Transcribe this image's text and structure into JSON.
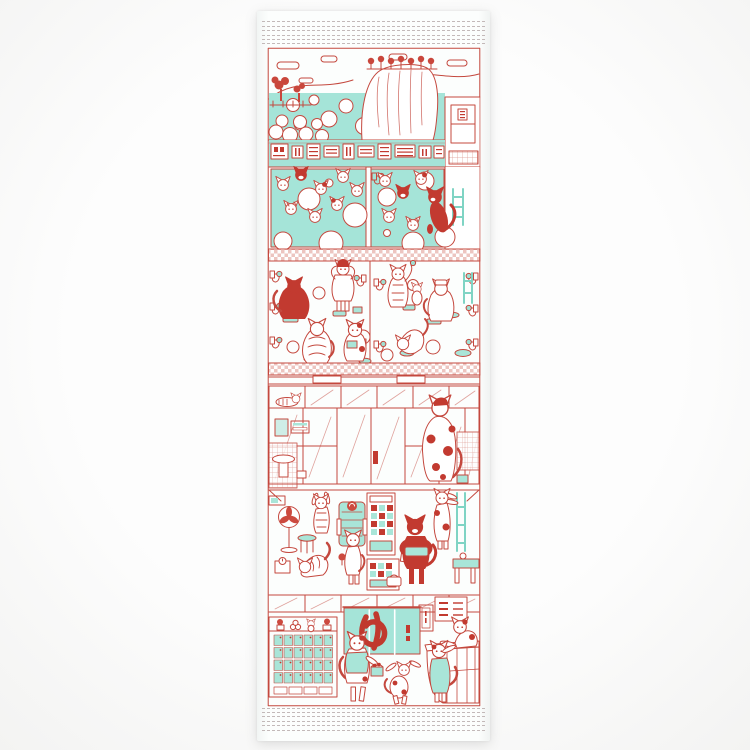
{
  "image": {
    "description": "White tenugui hand towel printed in red and teal with cats enjoying a Japanese public bathhouse: open-air bath, indoor pools, washing stations, glass partition, changing room and entrance."
  },
  "noren": {
    "character": "ゆ"
  },
  "scene_sections": {
    "open_air_bath": "open-air bath with rocks and mountains",
    "wall_signs": "bath-wall notice signs",
    "indoor_bath": "indoor pools with soaking cats",
    "washing_area": "washing stations with cats on stools",
    "glass_partition": "glass partition and vanity",
    "changing_room": "changing room with fan and vending machines",
    "entrance": "entrance with shoe lockers, noren curtain and counter"
  },
  "colors": {
    "line_red": "#c4483e",
    "solid_red": "#c23a30",
    "water_teal": "#a5e4d8",
    "teal_light": "#cfeee7",
    "tile_pink": "#edc5c0",
    "hem_stitch_gray": "#b6a9a9",
    "towel_white": "#fcfefd",
    "background_white": "#fdfdfd"
  }
}
